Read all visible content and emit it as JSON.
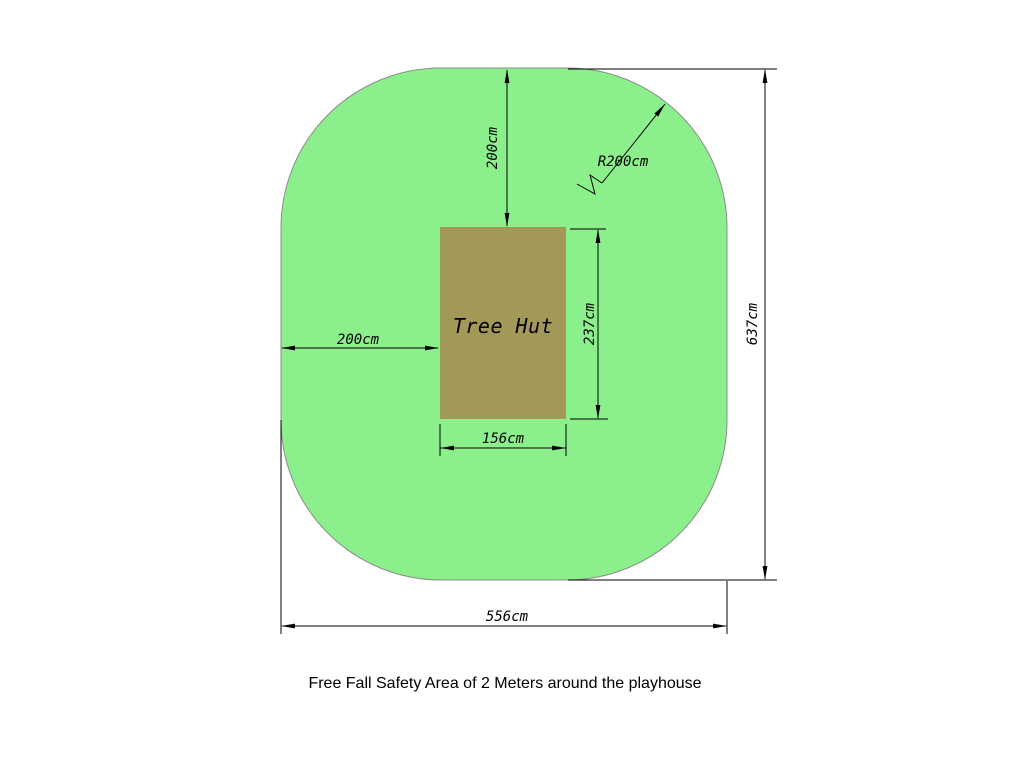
{
  "caption": "Free Fall Safety Area of 2 Meters around the playhouse",
  "hut": {
    "label": "Tree Hut",
    "fill": "#A29858"
  },
  "safety_area": {
    "fill": "#8BF08B"
  },
  "line_color": "#000000",
  "dims": {
    "top_offset": "200cm",
    "corner_radius": "R200cm",
    "hut_height": "237cm",
    "left_offset": "200cm",
    "hut_width": "156cm",
    "overall_height": "637cm",
    "overall_width": "556cm"
  }
}
